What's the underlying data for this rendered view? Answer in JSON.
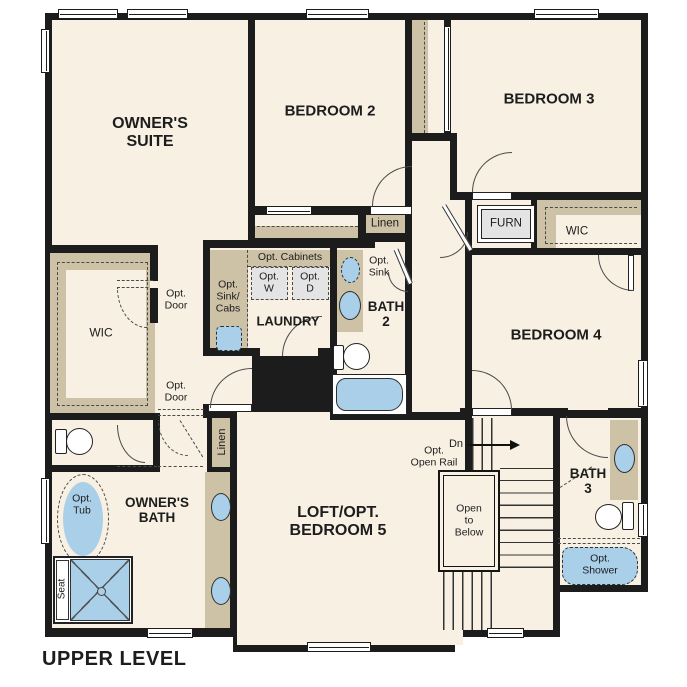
{
  "title": "UPPER LEVEL",
  "rooms": {
    "owners_suite": {
      "l1": "OWNER'S",
      "l2": "SUITE"
    },
    "bedroom2": {
      "l1": "BEDROOM 2"
    },
    "bedroom3": {
      "l1": "BEDROOM 3"
    },
    "bedroom4": {
      "l1": "BEDROOM 4"
    },
    "loft": {
      "l1": "LOFT/OPT.",
      "l2": "BEDROOM 5"
    },
    "owners_bath": {
      "l1": "OWNER'S",
      "l2": "BATH"
    },
    "bath2": {
      "l1": "BATH",
      "l2": "2"
    },
    "bath3": {
      "l1": "BATH",
      "l2": "3"
    },
    "laundry": {
      "l1": "LAUNDRY"
    },
    "wic_owners": {
      "l1": "WIC"
    },
    "wic_bedroom4": {
      "l1": "WIC"
    },
    "linen_hall": {
      "l1": "Linen"
    },
    "linen_owners": {
      "l1": "Linen"
    },
    "furnace": {
      "l1": "FURN"
    }
  },
  "annotations": {
    "opt_cabinets": "Opt. Cabinets",
    "opt_washer": {
      "l1": "Opt.",
      "l2": "W"
    },
    "opt_dryer": {
      "l1": "Opt.",
      "l2": "D"
    },
    "opt_sink_cabs": {
      "l1": "Opt.",
      "l2": "Sink/",
      "l3": "Cabs"
    },
    "opt_sink": {
      "l1": "Opt.",
      "l2": "Sink"
    },
    "opt_door_wic": {
      "l1": "Opt.",
      "l2": "Door"
    },
    "opt_door_hall": {
      "l1": "Opt.",
      "l2": "Door"
    },
    "opt_tub": {
      "l1": "Opt.",
      "l2": "Tub"
    },
    "shower_seat": "Seat",
    "stairs_down": "Dn",
    "opt_open_rail": {
      "l1": "Opt.",
      "l2": "Open Rail"
    },
    "open_to_below": {
      "l1": "Open",
      "l2": "to",
      "l3": "Below"
    },
    "opt_shower": {
      "l1": "Opt.",
      "l2": "Shower"
    }
  },
  "colors": {
    "background": "#ffffff",
    "floor": "#f7f0e3",
    "wall": "#1c1c1c",
    "cabinetry_tan": "#cdc1a6",
    "fixture_blue": "#a9cfe9",
    "appliance_gray": "#e4e4e4"
  }
}
